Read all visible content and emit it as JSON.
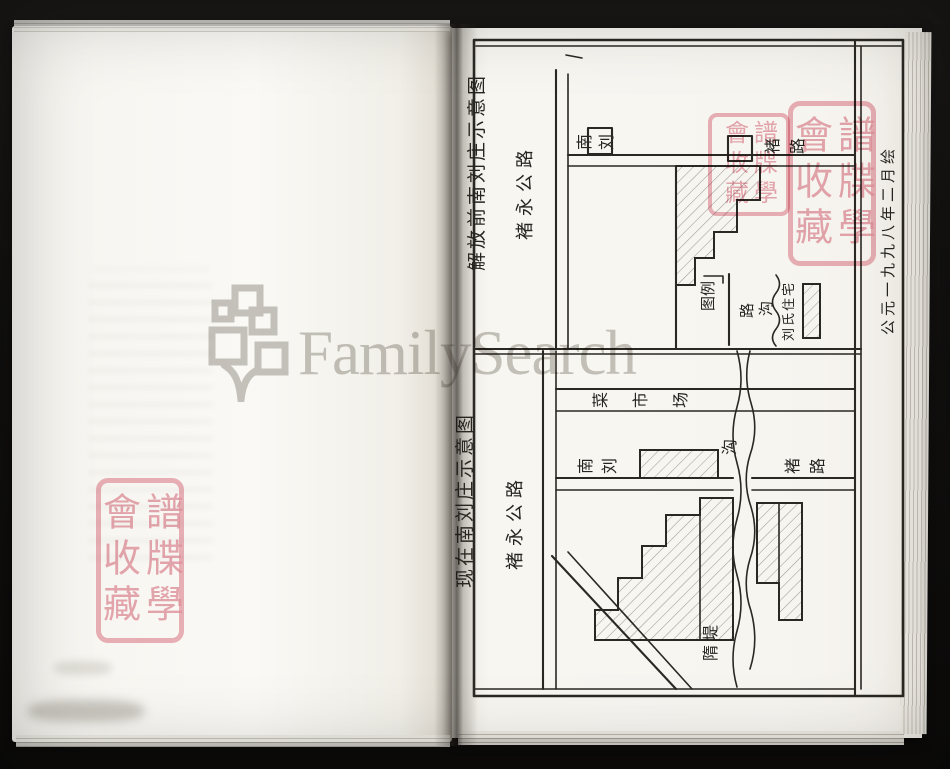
{
  "watermark": {
    "text": "FamilySearch"
  },
  "seal": {
    "right_column": "譜牒學",
    "left_column": "會收藏"
  },
  "figure": {
    "date_caption": "公元一九九八年二月绘",
    "upper_map": {
      "title": "解放前南刘庄示意图",
      "highway_label": "褚永公路",
      "village_label": "南刘",
      "road_label": "褚路",
      "legend": {
        "title": "图例",
        "road": "路",
        "ditch": "沟",
        "residence": "刘氏住宅"
      }
    },
    "lower_map": {
      "title": "现在南刘庄示意图",
      "highway_label": "褚永公路",
      "market_label": "菜市场",
      "village_label": "南刘",
      "ditch_label": "沟",
      "road_label": "褚路",
      "dike_label": "隋堤"
    }
  }
}
